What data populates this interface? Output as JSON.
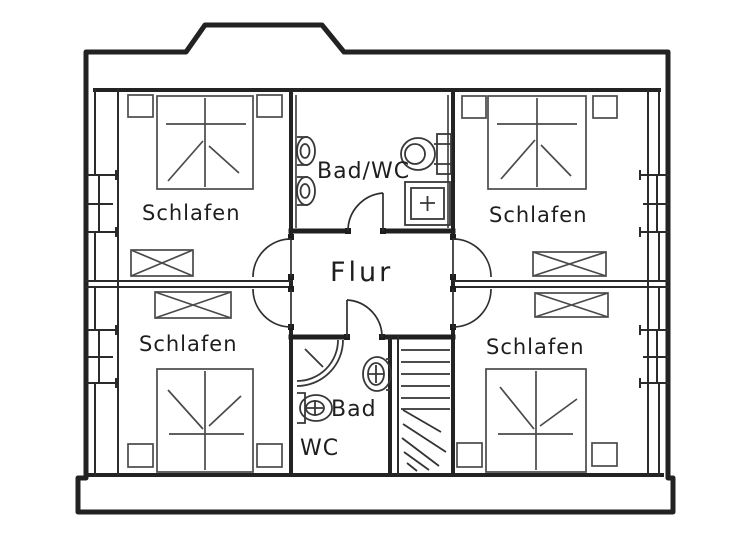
{
  "plan": {
    "type": "floor-plan",
    "rooms": {
      "bedroom_top_left": {
        "label": "Schlafen"
      },
      "bedroom_top_right": {
        "label": "Schlafen"
      },
      "bedroom_bottom_left": {
        "label": "Schlafen"
      },
      "bedroom_bottom_right": {
        "label": "Schlafen"
      },
      "bathroom_top": {
        "label": "Bad/WC"
      },
      "hallway": {
        "label": "Flur"
      },
      "bathroom_bottom": {
        "label_line1": "Bad",
        "label_line2": "WC"
      }
    },
    "symbols": {
      "double_beds": 4,
      "nightstands": 8,
      "wardrobes": 4,
      "washbasins": 3,
      "toilets": 2,
      "showers": 2,
      "doors": 6,
      "windows": 4,
      "staircase": "winder-stairs"
    },
    "colors": {
      "ink": "#222222",
      "furniture_ink": "#4a4a4a",
      "paper": "#ffffff"
    }
  }
}
